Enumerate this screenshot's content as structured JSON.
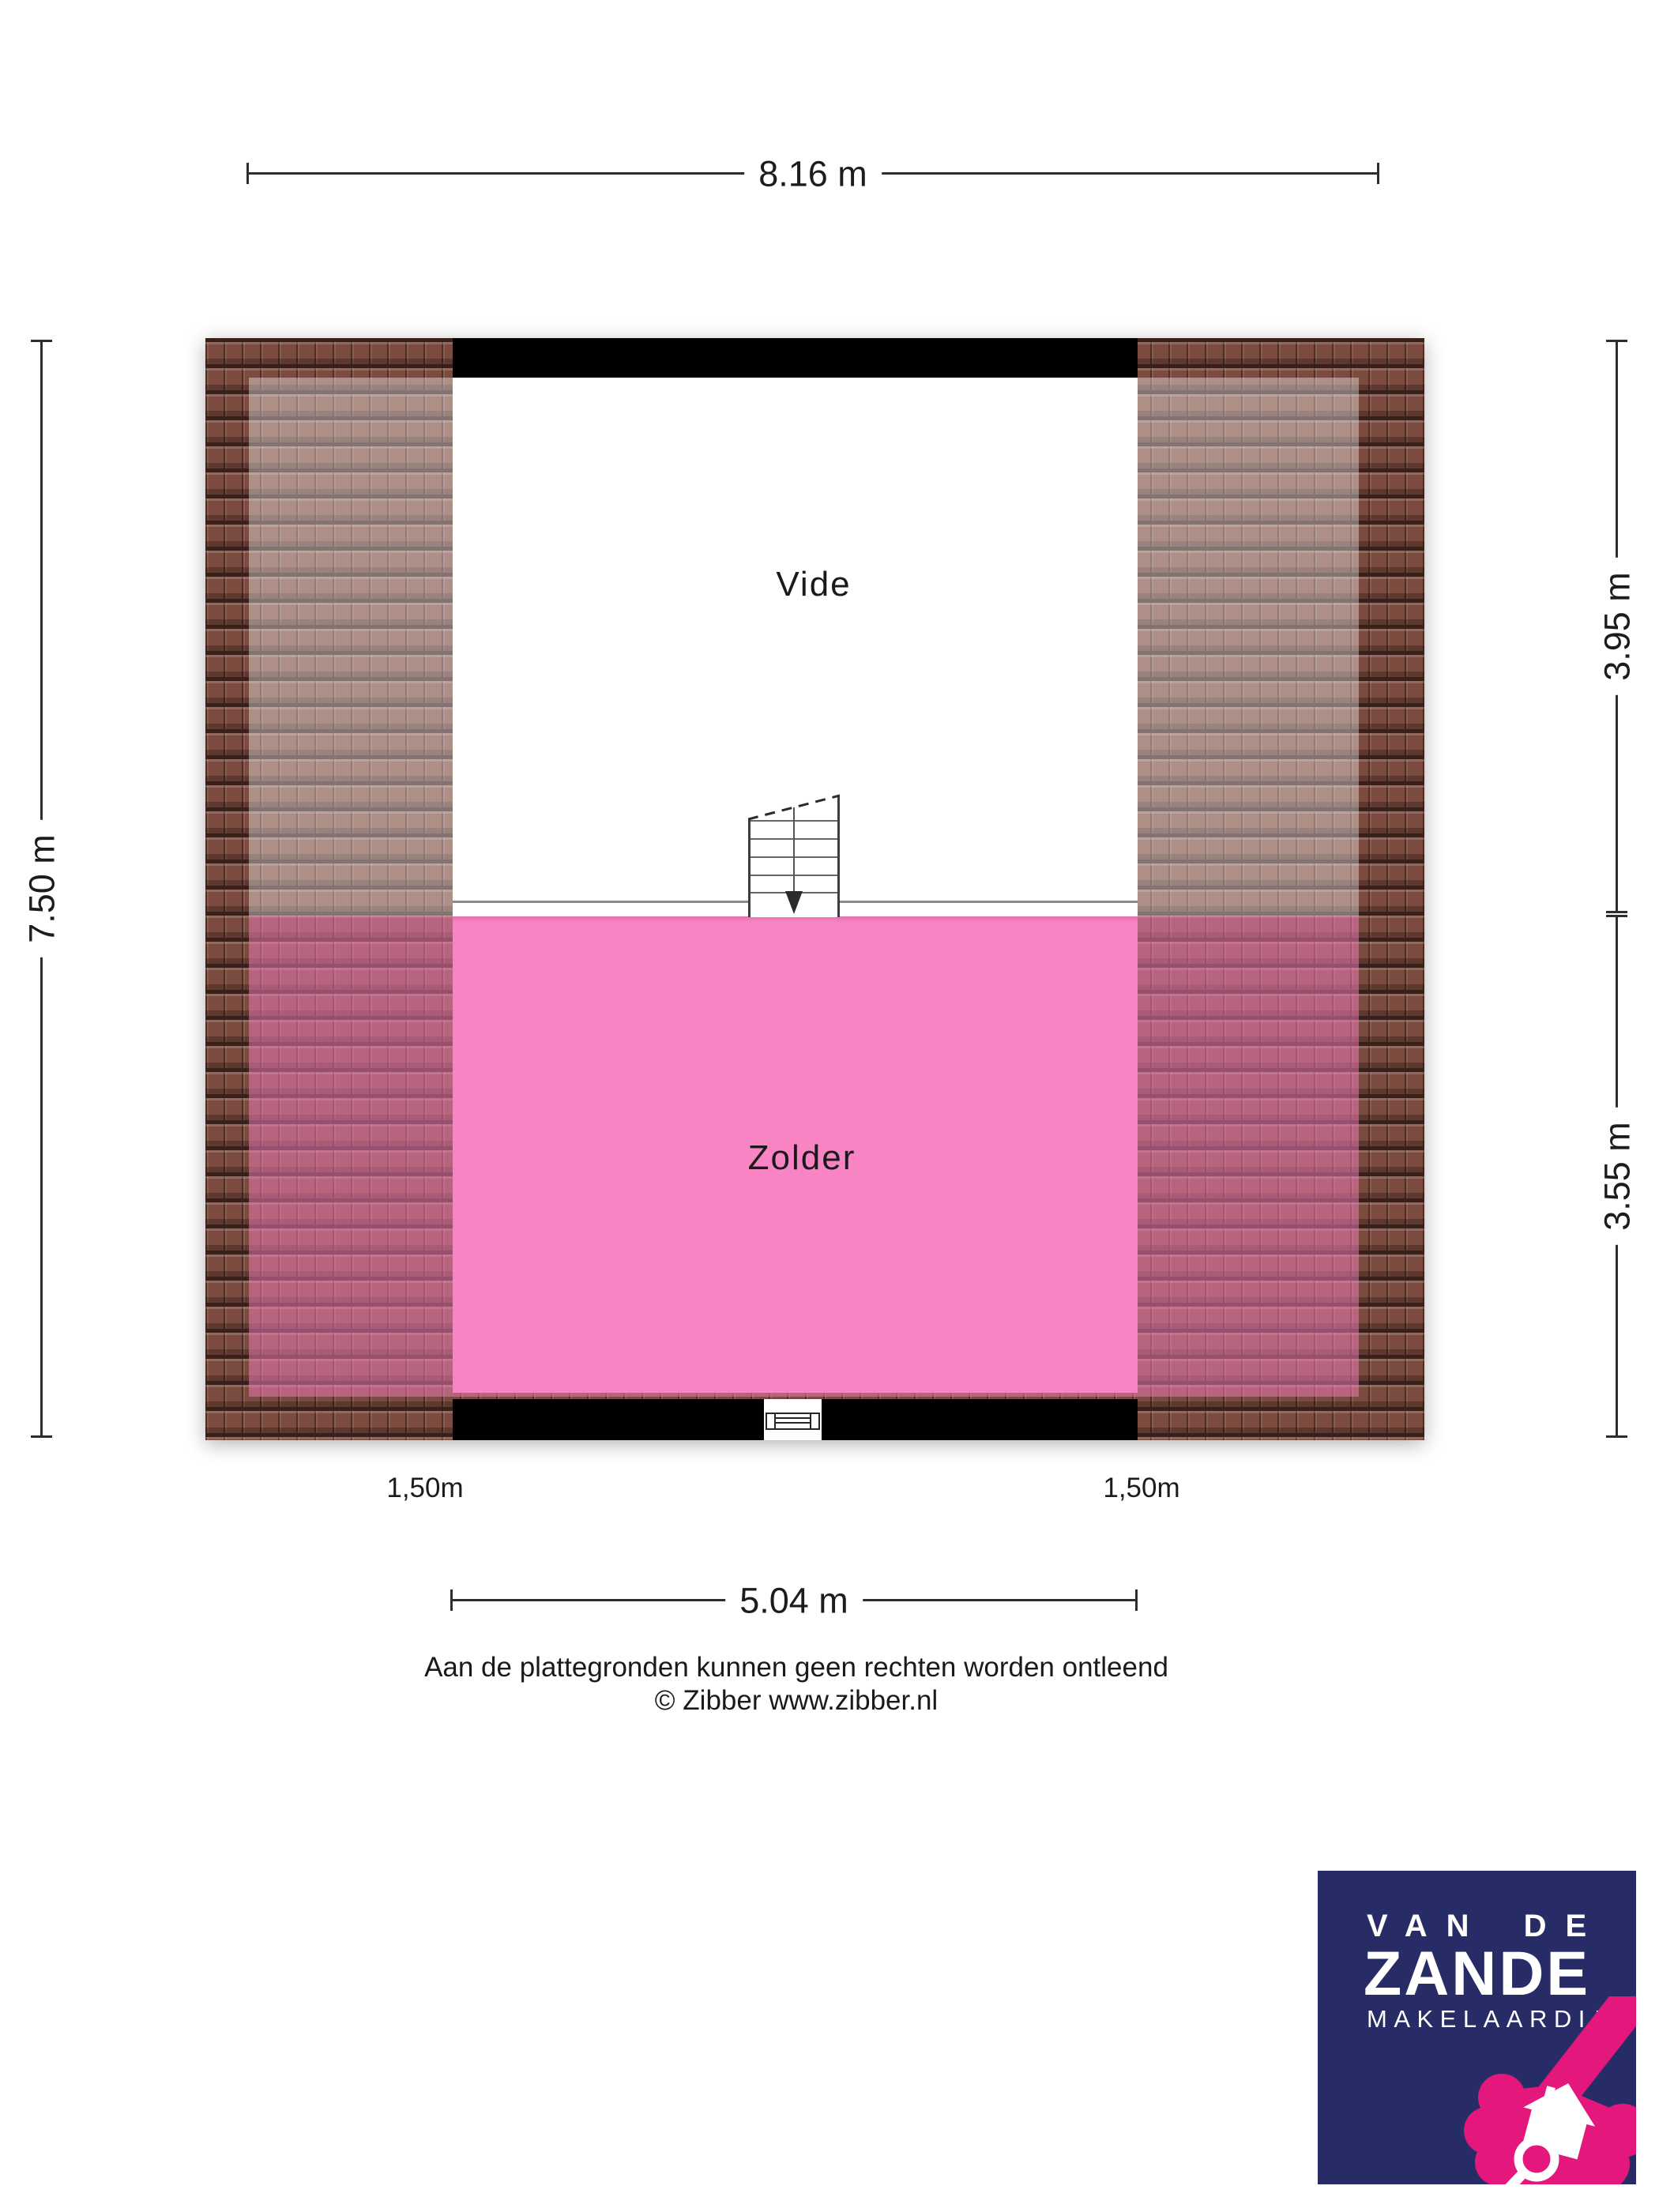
{
  "dimensions": {
    "top": "8.16 m",
    "left": "7.50 m",
    "right_upper": "3.95 m",
    "right_lower": "3.55 m",
    "bottom": "5.04 m",
    "headroom_left": "1,50m",
    "headroom_right": "1,50m"
  },
  "rooms": {
    "vide": "Vide",
    "zolder": "Zolder"
  },
  "colors": {
    "zolder_pink": "#f884c3",
    "roof_tile_brown": "#7b4b3f",
    "wall_black": "#000000",
    "logo_navy": "#282c66",
    "logo_pink": "#e4187c"
  },
  "footer": {
    "disclaimer": "Aan de plattegronden kunnen geen rechten worden ontleend",
    "copyright": "© Zibber www.zibber.nl"
  },
  "logo": {
    "line1": "VAN DE",
    "line2": "ZANDE",
    "line3": "MAKELAARDIJ"
  }
}
